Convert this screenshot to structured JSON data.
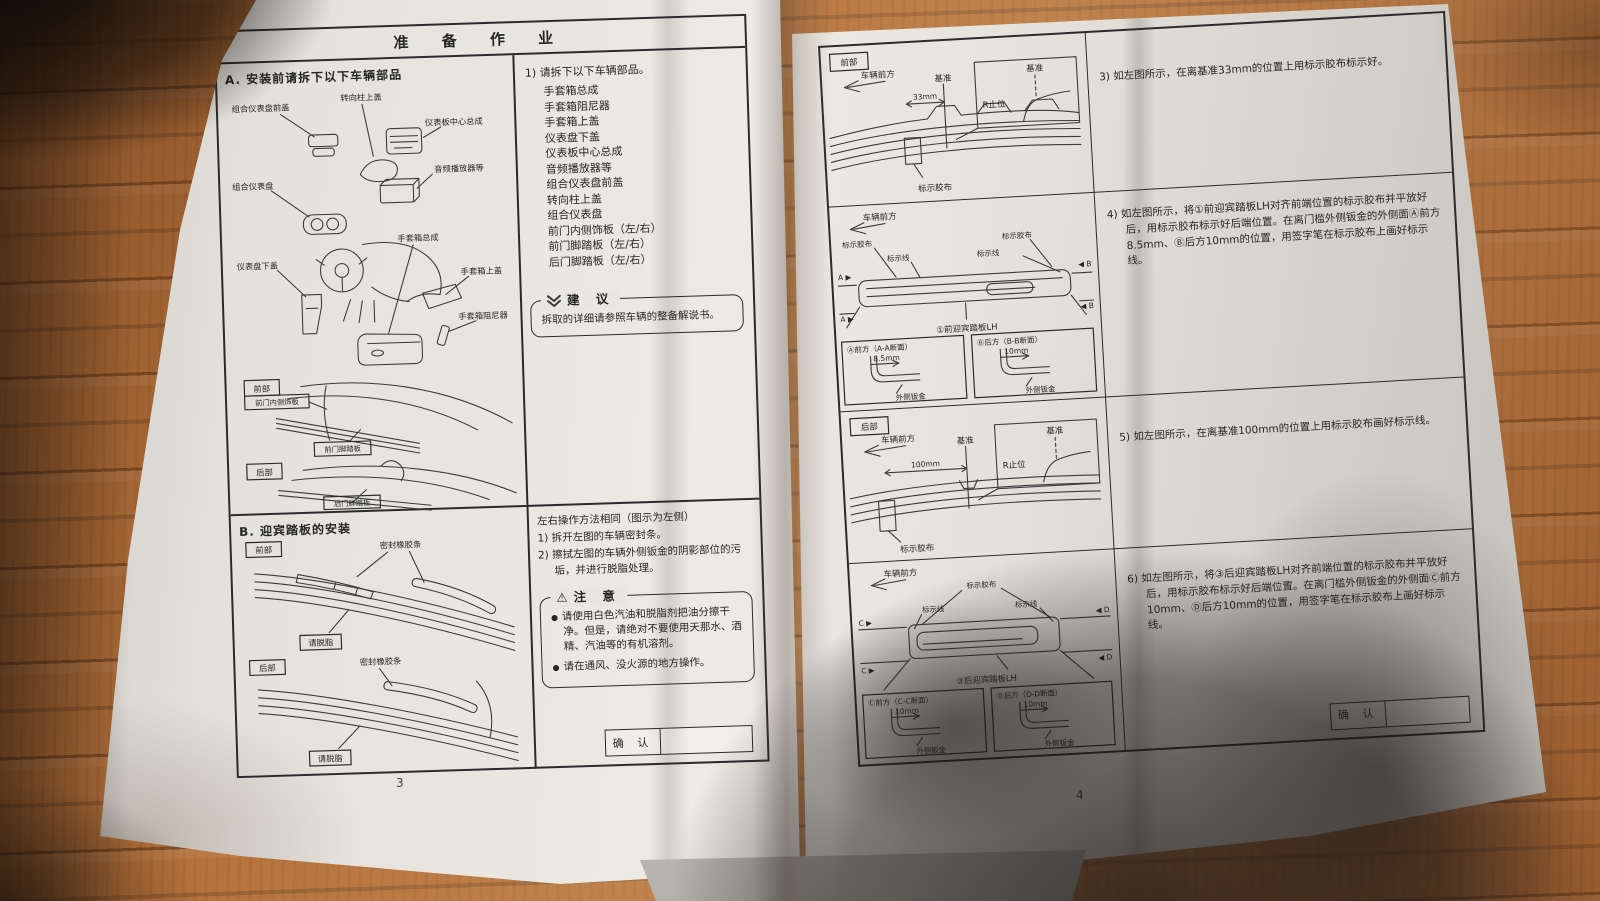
{
  "left_page": {
    "header": "准 备 作 业",
    "page_number": "3",
    "section_a": {
      "title": "A. 安装前请拆下以下车辆部品",
      "labels": {
        "cluster_front_cover": "组合仪表盘前盖",
        "steering_column_cover": "转向柱上盖",
        "panel_center": "仪表板中心总成",
        "audio": "音频播放器等",
        "cluster": "组合仪表盘",
        "panel_lower": "仪表盘下盖",
        "glovebox": "手套箱总成",
        "glovebox_cover": "手套箱上盖",
        "glovebox_damper": "手套箱阻尼器",
        "front_tag": "前部",
        "rear_tag": "后部",
        "front_door_trim": "前门内侧饰板",
        "front_door_scuff": "前门脚踏板",
        "rear_door_scuff": "后门脚踏板"
      }
    },
    "removal_list": {
      "intro": "1) 请拆下以下车辆部品。",
      "items": [
        "手套箱总成",
        "手套箱阻尼器",
        "手套箱上盖",
        "仪表盘下盖",
        "仪表板中心总成",
        "音频播放器等",
        "组合仪表盘前盖",
        "转向柱上盖",
        "组合仪表盘",
        "前门内侧饰板（左/右）",
        "前门脚踏板（左/右）",
        "后门脚踏板（左/右）"
      ]
    },
    "suggestion": {
      "title": "建 议",
      "text": "拆取的详细请参照车辆的整备解说书。"
    },
    "section_b": {
      "title": "B. 迎宾踏板的安装",
      "front_tag": "前部",
      "rear_tag": "后部",
      "seal_strip_front": "密封橡胶条",
      "seal_strip_rear": "密封橡胶条",
      "degrease_front": "请脱脂",
      "degrease_rear": "请脱脂"
    },
    "procedure": {
      "intro": "左右操作方法相同（图示为左侧）",
      "step1": "1) 拆开左图的车辆密封条。",
      "step2": "2) 擦拭左图的车辆外侧钣金的阴影部位的污垢，并进行脱脂处理。"
    },
    "caution": {
      "title": "注 意",
      "warn_icon": "⚠",
      "bullet1": "请使用白色汽油和脱脂剂把油分擦干净。但是，请绝对不要使用天那水、酒精、汽油等的有机溶剂。",
      "bullet2": "请在通风、没火源的地方操作。"
    },
    "confirm_label": "确 认"
  },
  "right_page": {
    "page_number": "4",
    "front_datum": {
      "tag": "前部",
      "direction": "车辆前方",
      "datum": "基准",
      "dim": "33mm",
      "r_stop": "R止位",
      "inset_datum": "基准",
      "tape": "标示胶布"
    },
    "front_scuff": {
      "direction": "车辆前方",
      "tape_left": "标示胶布",
      "line_left": "标示线",
      "tape_right": "标示胶布",
      "line_right": "标示线",
      "a_top": "A ▶",
      "a_bottom": "A ▶",
      "b_top": "◀ B",
      "b_bottom": "◀ B",
      "caption": "①前迎宾踏板LH"
    },
    "section_aa": {
      "title": "Ⓐ前方（A-A断面）",
      "dim": "8.5mm",
      "metal": "外侧钣金"
    },
    "section_bb": {
      "title": "Ⓑ后方（B-B断面）",
      "dim": "10mm",
      "metal": "外侧钣金"
    },
    "rear_datum": {
      "tag": "后部",
      "direction": "车辆前方",
      "datum": "基准",
      "dim": "100mm",
      "r_stop": "R止位",
      "inset_datum": "基准",
      "tape": "标示胶布"
    },
    "rear_scuff": {
      "direction": "车辆前方",
      "tape": "标示胶布",
      "line_left": "标示线",
      "line_right": "标示线",
      "c_top": "C ▶",
      "c_bottom": "C ▶",
      "d_top": "◀ D",
      "d_bottom": "◀ D",
      "caption": "③后迎宾踏板LH"
    },
    "section_cc": {
      "title": "Ⓒ前方（C-C断面）",
      "dim": "10mm",
      "metal": "外侧钣金"
    },
    "section_dd": {
      "title": "Ⓓ后方（D-D断面）",
      "dim": "10mm",
      "metal": "外侧钣金"
    },
    "steps": [
      {
        "text": "3) 如左图所示，在离基准33mm的位置上用标示胶布标示好。"
      },
      {
        "text": "4) 如左图所示，将①前迎宾踏板LH对齐前端位置的标示胶布并平放好后，用标示胶布标示好后端位置。在离门槛外侧钣金的外侧面Ⓐ前方8.5mm、Ⓑ后方10mm的位置，用签字笔在标示胶布上画好标示线。"
      },
      {
        "text": "5) 如左图所示，在离基准100mm的位置上用标示胶布画好标示线。"
      },
      {
        "text": "6) 如左图所示，将③后迎宾踏板LH对齐前端位置的标示胶布并平放好后，用标示胶布标示好后端位置。在离门槛外侧钣金的外侧面Ⓒ前方10mm、Ⓓ后方10mm的位置，用签字笔在标示胶布上画好标示线。"
      }
    ],
    "confirm_label": "确 认"
  }
}
